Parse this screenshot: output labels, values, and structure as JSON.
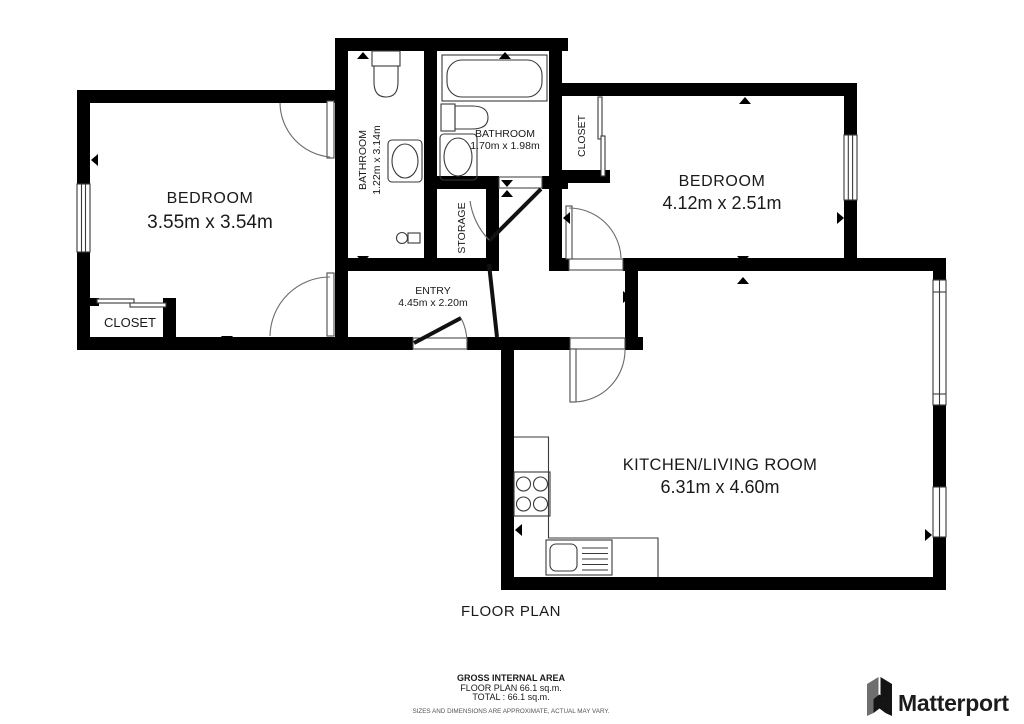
{
  "plan": {
    "rooms": [
      {
        "id": "bedroom-left",
        "name": "BEDROOM",
        "dims": "3.55m x 3.54m"
      },
      {
        "id": "closet-left",
        "name": "CLOSET"
      },
      {
        "id": "bathroom-mid",
        "name": "BATHROOM",
        "dims": "1.22m x 3.14m"
      },
      {
        "id": "bathroom-top",
        "name": "BATHROOM",
        "dims": "1.70m x 1.98m"
      },
      {
        "id": "storage",
        "name": "STORAGE"
      },
      {
        "id": "closet-top",
        "name": "CLOSET"
      },
      {
        "id": "bedroom-right",
        "name": "BEDROOM",
        "dims": "4.12m x 2.51m"
      },
      {
        "id": "entry",
        "name": "ENTRY",
        "dims": "4.45m x 2.20m"
      },
      {
        "id": "kitchen",
        "name": "KITCHEN/LIVING ROOM",
        "dims": "6.31m x 4.60m"
      }
    ],
    "title": "FLOOR PLAN",
    "footer": {
      "area_label": "GROSS INTERNAL AREA",
      "floor_plan_area": "FLOOR PLAN 66.1 sq.m.",
      "total_area": "TOTAL :  66.1 sq.m.",
      "disclaimer": "SIZES AND DIMENSIONS ARE APPROXIMATE, ACTUAL MAY VARY."
    },
    "brand": {
      "name": "Matterport"
    },
    "colors": {
      "wall": "#000000",
      "text": "#1a1a1a",
      "fixture_stroke": "#3a3a3a"
    }
  }
}
